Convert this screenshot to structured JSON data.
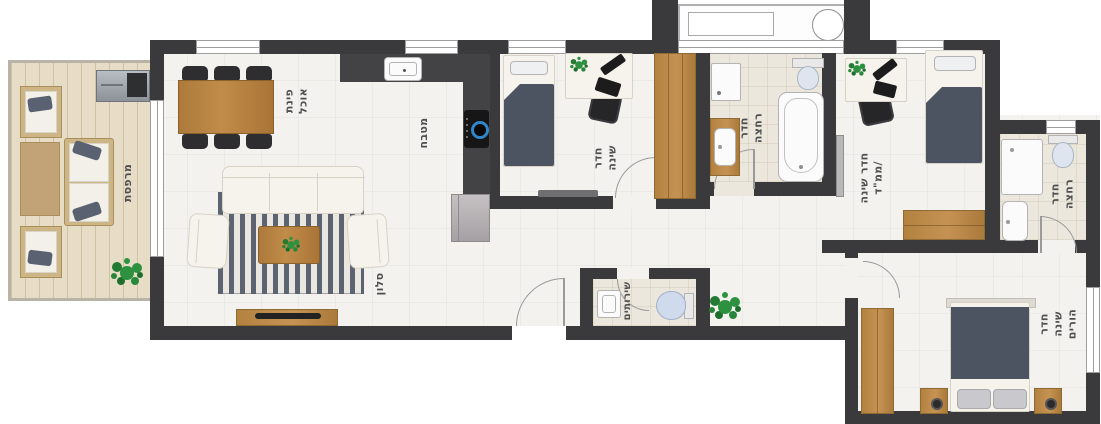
{
  "plan": {
    "type": "apartment-floor-plan",
    "language": "he",
    "colors": {
      "walls": "#3a3a3c",
      "floor": "#f3f2ef",
      "bath_floor": "#ebe7dd",
      "balcony_deck": "#e7ddc6",
      "wood_furniture": "#b5803f",
      "bedding_navy": "#4d5461",
      "rug_stripe": "#5d6471",
      "toilet_blue": "#cfdaed",
      "plant_green": "#2e9140",
      "label_text": "#4f4f4f"
    },
    "rooms": [
      {
        "id": "balcony",
        "label": "מרפסת"
      },
      {
        "id": "dining",
        "label": "פינת\nאוכל"
      },
      {
        "id": "living",
        "label": "סלון"
      },
      {
        "id": "kitchen",
        "label": "מטבח"
      },
      {
        "id": "bedroom1",
        "label": "חדר\nשינה"
      },
      {
        "id": "bathroom1",
        "label": "חדר\nרחצה"
      },
      {
        "id": "bedroom2",
        "label": "חדר שינה\n/ממ\"ד"
      },
      {
        "id": "bathroom2",
        "label": "חדר\nרחצה"
      },
      {
        "id": "wc",
        "label": "שירותים"
      },
      {
        "id": "master",
        "label": "חדר שינה\nהורים"
      }
    ]
  }
}
